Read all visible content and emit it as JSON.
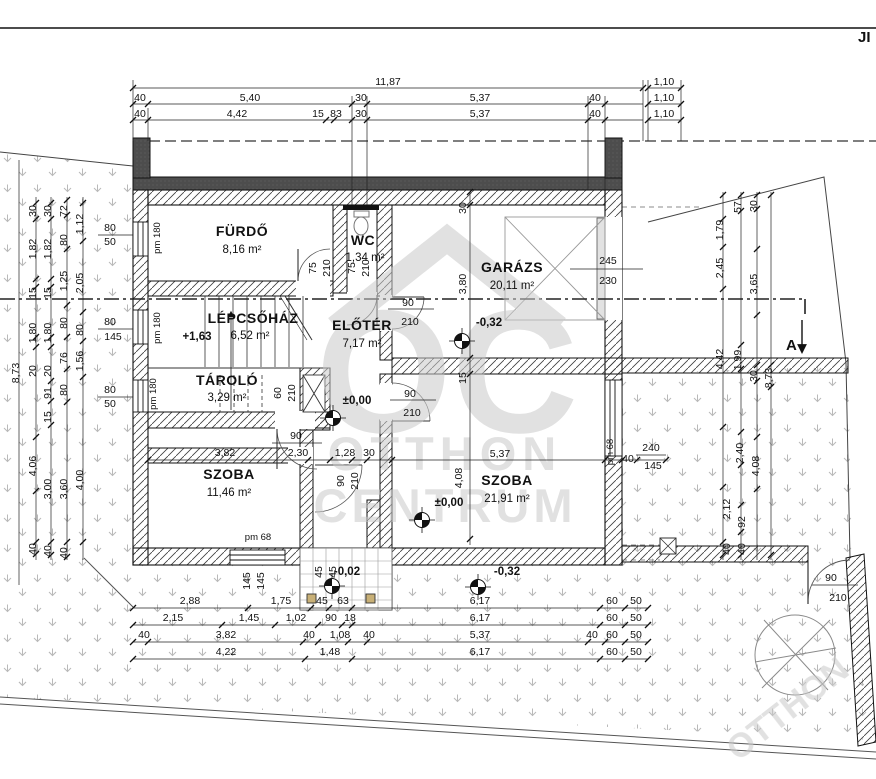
{
  "meta": {
    "corner_note": "JI",
    "section_marker": "A"
  },
  "watermark": {
    "logo": "OC",
    "line1": "OTTHON",
    "line2": "CENTRUM",
    "corner": "OTTHON"
  },
  "rooms": [
    {
      "name": "FÜRDŐ",
      "area": "8,16 m²"
    },
    {
      "name": "WC",
      "area": "1,34 m²"
    },
    {
      "name": "GARÁZS",
      "area": "20,11 m²"
    },
    {
      "name": "LÉPCSŐHÁZ",
      "area": "6,52 m²"
    },
    {
      "name": "ELŐTÉR",
      "area": "7,17 m²"
    },
    {
      "name": "TÁROLÓ",
      "area": "3,29 m²"
    },
    {
      "name": "SZOBA",
      "area": "11,46 m²"
    },
    {
      "name": "SZOBA",
      "area": "21,91 m²"
    }
  ],
  "levels": [
    "+1,63",
    "±0,00",
    "±0,00",
    "-0,32",
    "-0,02",
    "-0,32"
  ],
  "dims": {
    "top1": [
      "11,87",
      "1,10"
    ],
    "top2": [
      "40",
      "5,40",
      "30",
      "5,37",
      "40",
      "1,10"
    ],
    "top3": [
      "40",
      "4,42",
      "15",
      "83",
      "30",
      "5,37",
      "40",
      "1,10"
    ],
    "left": [
      "8,73",
      "30",
      "1,82",
      "15",
      "1,80",
      "20",
      "4,06",
      "40",
      "30",
      "1,82",
      "15",
      "1,80",
      "20",
      "91",
      "15",
      "3,00",
      "40",
      "72",
      "80",
      "1,25",
      "80",
      "76",
      "80",
      "3,60",
      "40",
      "1,12",
      "2,05",
      "80",
      "1,56",
      "4,00"
    ],
    "left_windows": [
      "80",
      "50",
      "80",
      "145",
      "80",
      "50"
    ],
    "right": [
      "1,79",
      "2,45",
      "4,42",
      "2,12",
      "40",
      "57",
      "1,99",
      "2,40",
      "92",
      "40",
      "30",
      "3,65",
      "30",
      "4,08",
      "8,73"
    ],
    "bottom1": [
      "2,88",
      "1,75",
      "45",
      "63",
      "6,17",
      "60",
      "50"
    ],
    "bottom2": [
      "2,15",
      "1,45",
      "1,02",
      "90",
      "18",
      "6,17",
      "60",
      "50"
    ],
    "bottom3": [
      "40",
      "3,82",
      "40",
      "1,08",
      "40",
      "5,37",
      "40",
      "60",
      "50"
    ],
    "bottom4": [
      "4,22",
      "1,48",
      "6,17",
      "60",
      "50"
    ],
    "bottom_rot": [
      "145",
      "145",
      "45",
      "45"
    ],
    "inner": [
      "3,82",
      "2,30",
      "1,28",
      "30",
      "5,37",
      "40",
      "30",
      "3,80",
      "15",
      "4,08",
      "90",
      "90",
      "210",
      "90",
      "210",
      "75",
      "210",
      "75",
      "210",
      "90",
      "210",
      "60",
      "210"
    ],
    "fractions": {
      "garage_door": [
        "245",
        "230"
      ],
      "right_window": [
        "240",
        "145"
      ],
      "gate": [
        "90",
        "210"
      ]
    },
    "pm": [
      "pm 180",
      "pm 180",
      "pm 180",
      "pm 68",
      "pm 68"
    ]
  }
}
